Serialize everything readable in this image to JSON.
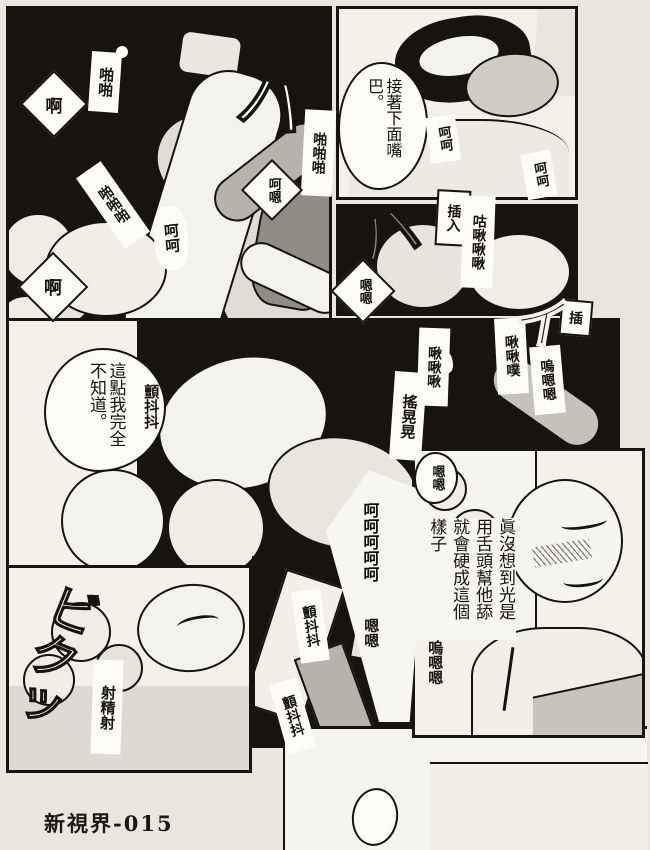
{
  "colors": {
    "ink": "#17140f",
    "paper": "#e9e6de",
    "panel_white": "#f3f1ea"
  },
  "footer": {
    "label": "新視界-015"
  },
  "panelA": {
    "moan_ah_1": "啊",
    "sfx_slap_2": "啪啪",
    "sfx_pa": "パ",
    "sfx_slap_3a": "啪啪啪",
    "sfx_slap_3b": "啪啪啪",
    "moan_hoho": "呵呵",
    "moan_ho_n": "呵嗯",
    "moan_ah_2": "啊"
  },
  "panelB": {
    "dialogue": "接著下面嘴巴。",
    "moan_hoho_1": "呵呵",
    "moan_hoho_2": "呵呵"
  },
  "panelC": {
    "label_insert": "插入",
    "sfx_slurp": "咕啾啾啾",
    "sfx_ha": "ハ",
    "moan_nn": "嗯嗯"
  },
  "panelD": {
    "dialogue": "這點我完全不知道。",
    "sfx_tremble": "顫抖抖",
    "sfx_chu_a": "啾啾啾",
    "sfx_chu_b": "啾啾噗",
    "moan_u_nn": "嗚嗯嗯",
    "sfx_i": "イ",
    "label_insert": "插",
    "sfx_sway": "搖晃晃",
    "moan_nn": "嗯嗯"
  },
  "panelE": {
    "sfx_twitch": "ビクッ",
    "label_ejaculate": "射精射"
  },
  "panelF": {
    "sfx_tremble_1": "顫抖抖",
    "sfx_tremble_2": "顫抖抖"
  },
  "bubbleFG": {
    "moan_hohohohoho": "呵呵呵呵呵",
    "moan_nn": "嗯嗯"
  },
  "panelG": {
    "dialogue": "眞沒想到光是用舌頭幫他舔就會硬成這個樣子",
    "moan_u_nn": "嗚嗯嗯"
  }
}
